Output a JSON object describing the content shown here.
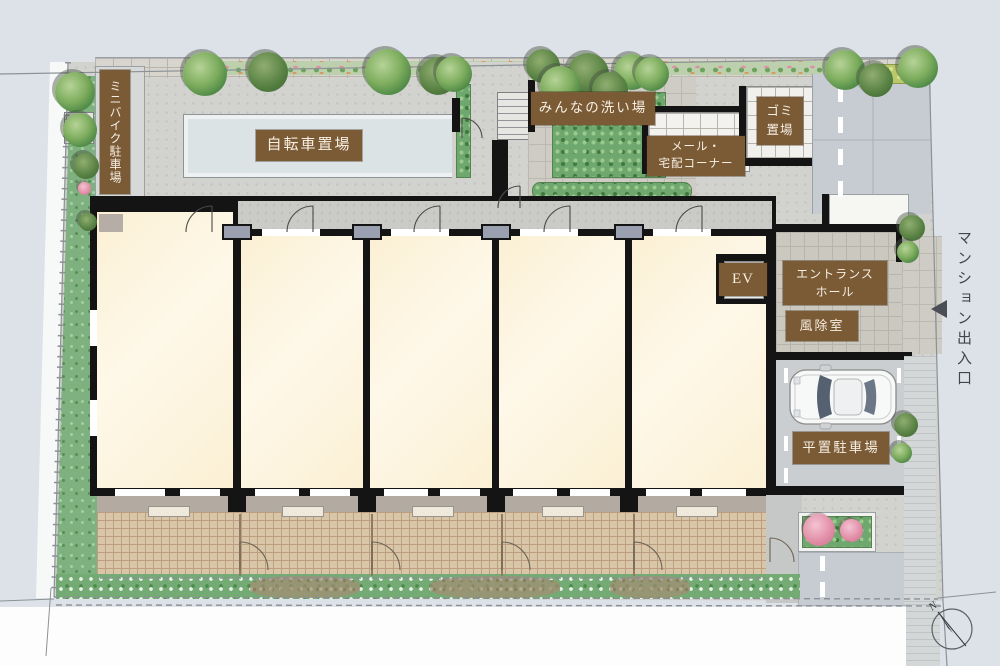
{
  "colors": {
    "background": "#dde2e8",
    "badge": "#7b5a36",
    "badge_text": "#f6efe2",
    "room_fill": "#fdf4dd",
    "wall": "#141414",
    "greenery": "#7fb07f",
    "terrace": "#d9c6a9"
  },
  "areas": {
    "mini_bike_parking": "ミニバイク駐車場",
    "bicycle_parking": "自転車置場",
    "washing_area": "みんなの洗い場",
    "mail_delivery_corner": "メール・\n宅配コーナー",
    "garbage_storage": "ゴミ\n置場",
    "elevator": "EV",
    "entrance_hall": "エントランス\nホール",
    "windbreak_room": "風除室",
    "flat_parking": "平置駐車場"
  },
  "annotations": {
    "building_entrance": "マンション出入口",
    "compass_north": "N"
  }
}
